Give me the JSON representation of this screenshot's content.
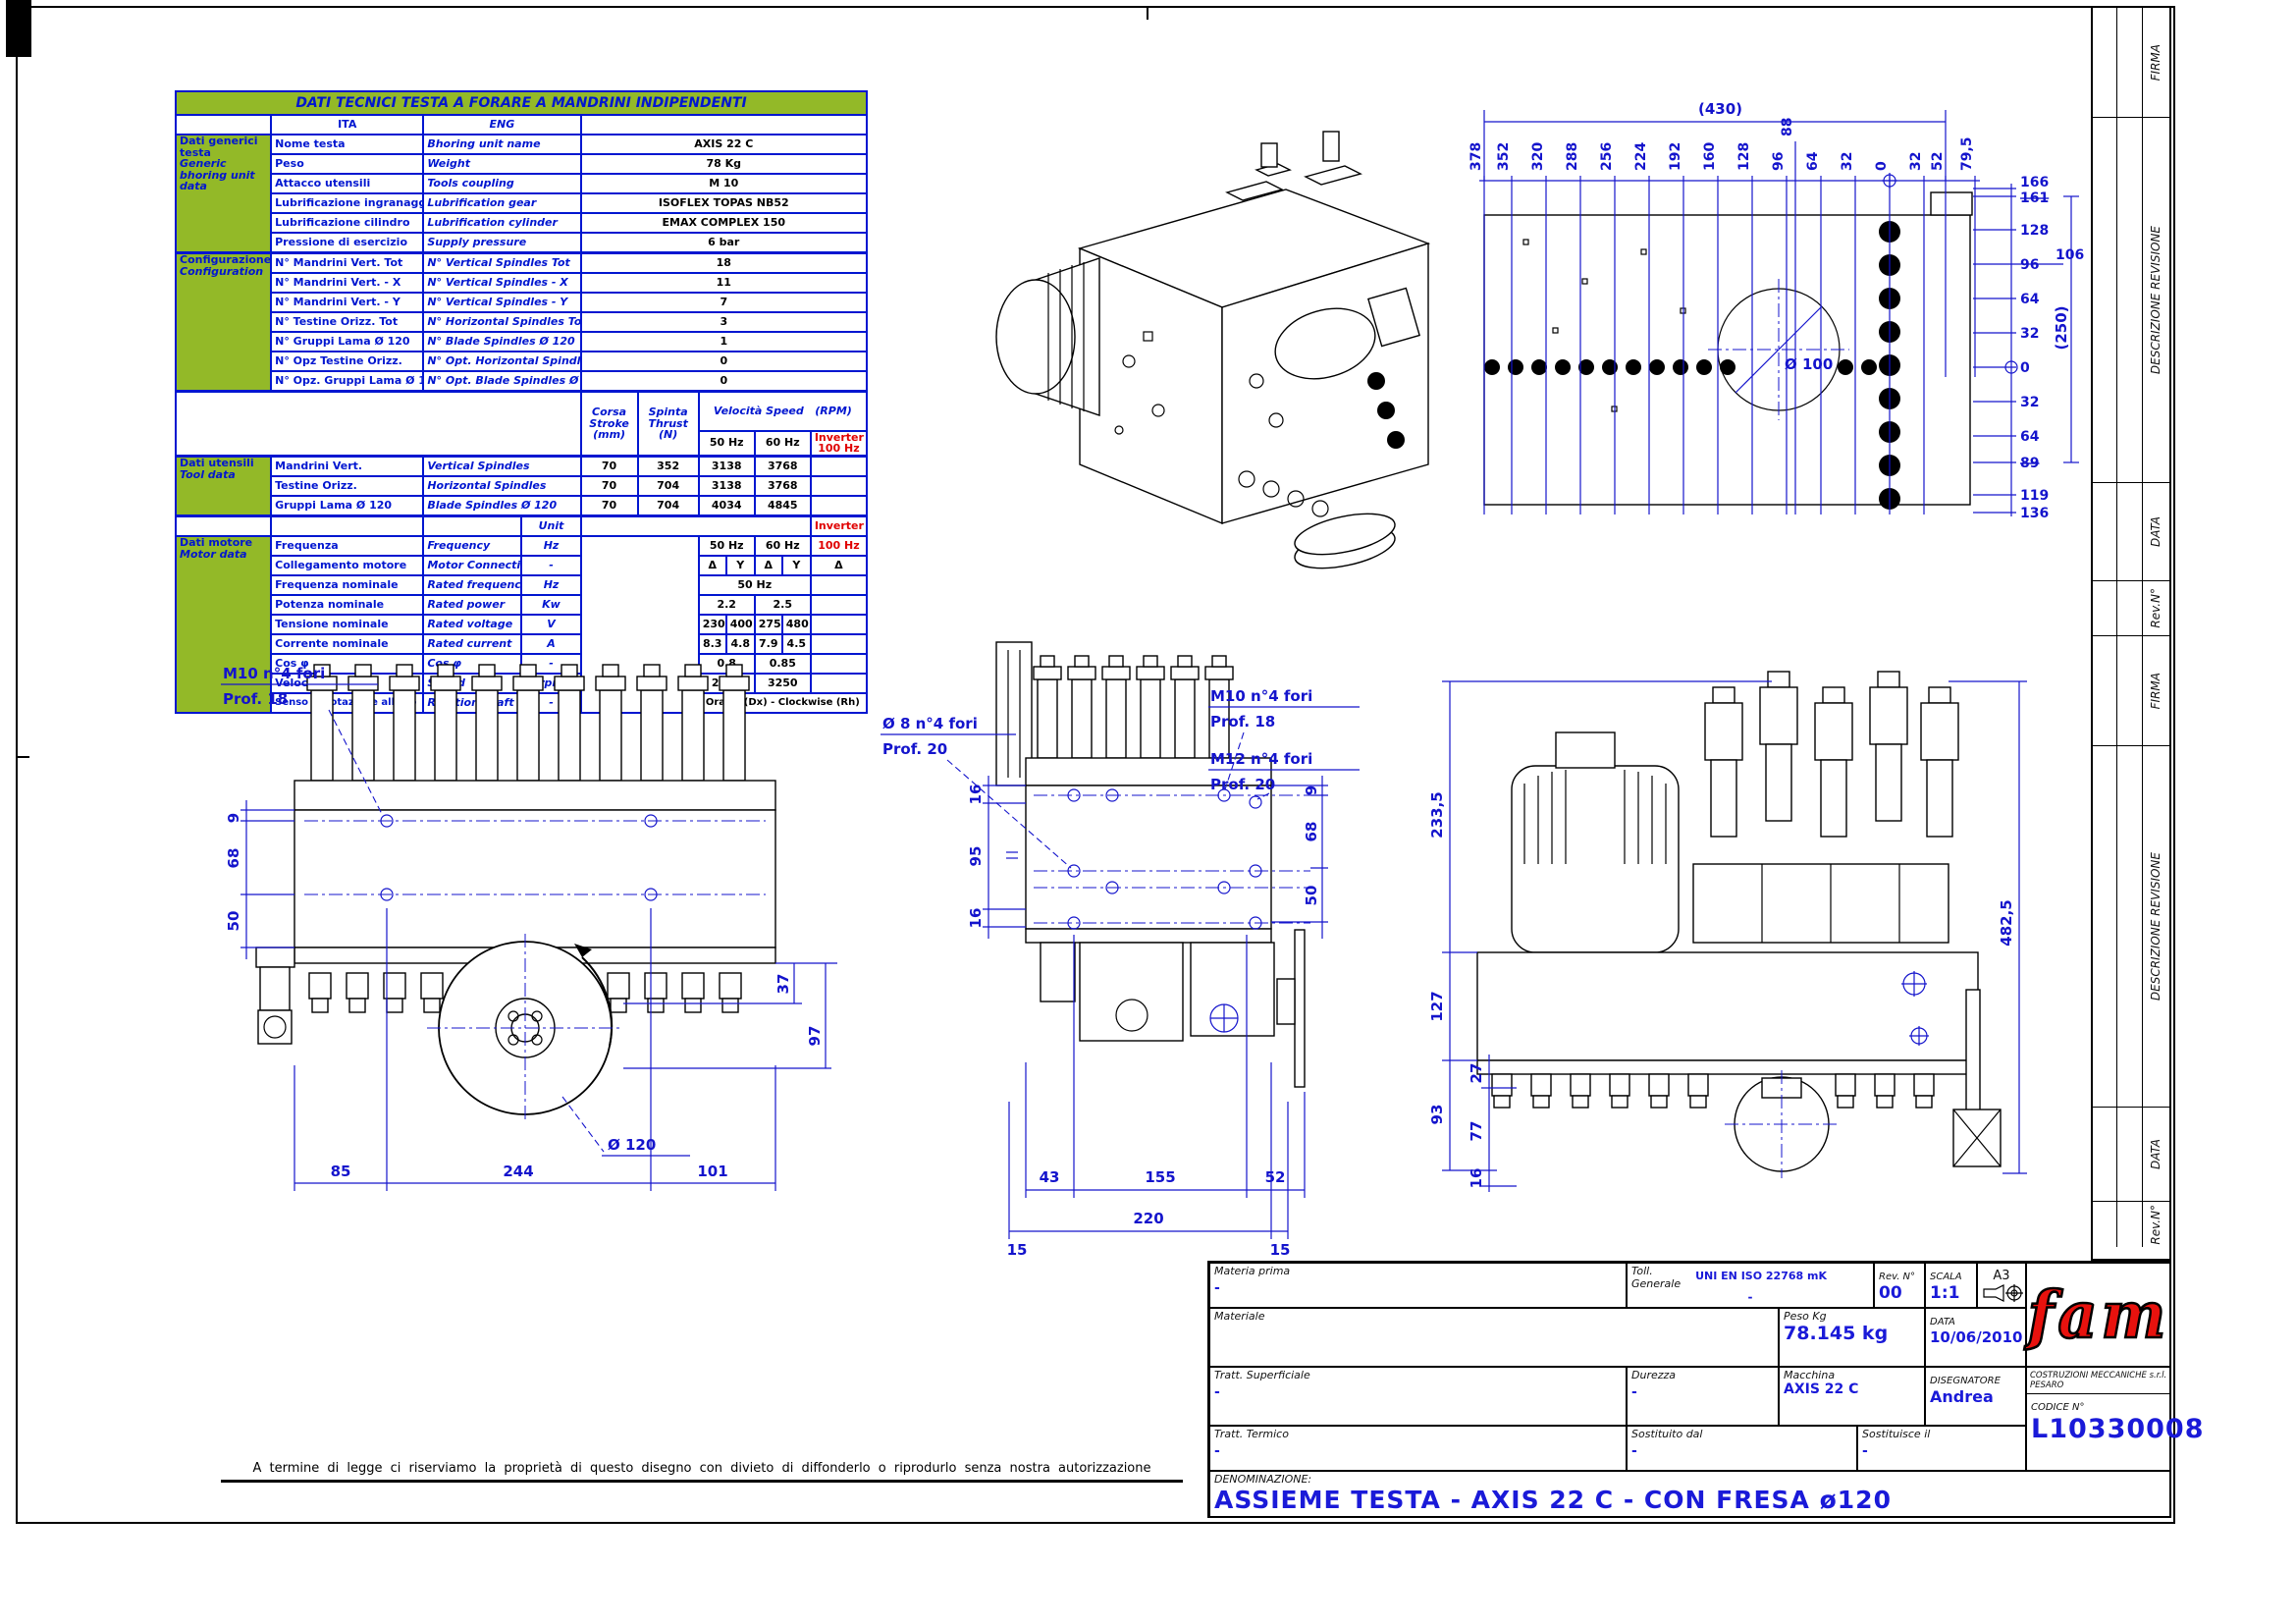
{
  "sheet": {
    "disclaimer": "A termine di legge ci riserviamo la proprietà di questo disegno con divieto di diffonderlo o riprodurlo senza nostra autorizzazione"
  },
  "colors": {
    "drawing_blue": "#1414cc",
    "table_blue": "#0016d0",
    "table_green": "#93b928",
    "alert_red": "#e00000",
    "logo_red": "#e8120e"
  },
  "tech_table": {
    "title": "DATI TECNICI TESTA A FORARE A MANDRINI INDIPENDENTI",
    "col_ita": "ITA",
    "col_eng": "ENG",
    "general": {
      "group_ita": "Dati generici testa",
      "group_eng": "Generic bhoring unit data",
      "rows": [
        {
          "ita": "Nome testa",
          "eng": "Bhoring unit name",
          "value": "AXIS 22 C"
        },
        {
          "ita": "Peso",
          "eng": "Weight",
          "value": "78 Kg"
        },
        {
          "ita": "Attacco utensili",
          "eng": "Tools coupling",
          "value": "M 10"
        },
        {
          "ita": "Lubrificazione ingranaggi",
          "eng": "Lubrification gear",
          "value": "ISOFLEX TOPAS NB52"
        },
        {
          "ita": "Lubrificazione cilindro",
          "eng": "Lubrification cylinder",
          "value": "EMAX COMPLEX 150"
        },
        {
          "ita": "Pressione di esercizio",
          "eng": "Supply pressure",
          "value": "6 bar"
        }
      ]
    },
    "config": {
      "group_ita": "Configurazione",
      "group_eng": "Configuration",
      "rows": [
        {
          "ita": "N° Mandrini Vert. Tot",
          "eng": "N° Vertical Spindles Tot",
          "value": "18"
        },
        {
          "ita": "N° Mandrini Vert. - X",
          "eng": "N° Vertical Spindles - X",
          "value": "11"
        },
        {
          "ita": "N° Mandrini Vert. - Y",
          "eng": "N° Vertical Spindles - Y",
          "value": "7"
        },
        {
          "ita": "N° Testine Orizz. Tot",
          "eng": "N° Horizontal Spindles Tot",
          "value": "3"
        },
        {
          "ita": "N° Gruppi Lama Ø 120",
          "eng": "N° Blade Spindles Ø 120",
          "value": "1"
        },
        {
          "ita": "N° Opz Testine Orizz.",
          "eng": "N° Opt. Horizontal Spindles",
          "value": "0"
        },
        {
          "ita": "N° Opz. Gruppi Lama Ø 120",
          "eng": "N° Opt. Blade Spindles Ø 120",
          "value": "0"
        }
      ]
    },
    "speed_header": {
      "corsa": "Corsa",
      "stroke": "Stroke",
      "mm": "(mm)",
      "spinta": "Spinta",
      "thrust": "Thrust",
      "n": "(N)",
      "velocita": "Velocità Speed",
      "rpm": "(RPM)",
      "hz50": "50 Hz",
      "hz60": "60 Hz",
      "inverter": "Inverter",
      "hz100": "100 Hz"
    },
    "tools": {
      "group_ita": "Dati utensili",
      "group_eng": "Tool data",
      "rows": [
        {
          "ita": "Mandrini Vert.",
          "eng": "Vertical Spindles",
          "corsa": "70",
          "spinta": "352",
          "v50": "3138",
          "v60": "3768"
        },
        {
          "ita": "Testine Orizz.",
          "eng": "Horizontal Spindles",
          "corsa": "70",
          "spinta": "704",
          "v50": "3138",
          "v60": "3768"
        },
        {
          "ita": "Gruppi Lama Ø 120",
          "eng": "Blade Spindles Ø 120",
          "corsa": "70",
          "spinta": "704",
          "v50": "4034",
          "v60": "4845"
        }
      ]
    },
    "motor": {
      "group_ita": "Dati motore",
      "group_eng": "Motor data",
      "unit": "Unit",
      "inverter": "Inverter",
      "freq": {
        "ita": "Frequenza",
        "eng": "Frequency",
        "unit": "Hz",
        "c1": "50 Hz",
        "c2": "60 Hz",
        "c3": "100 Hz"
      },
      "conn": {
        "ita": "Collegamento motore",
        "eng": "Motor Connection",
        "unit": "-",
        "d1": "Δ",
        "y1": "Y",
        "d2": "Δ",
        "y2": "Y",
        "inv": "Δ"
      },
      "rfreq": {
        "ita": "Frequenza nominale",
        "eng": "Rated frequency",
        "unit": "Hz",
        "value": "50 Hz"
      },
      "power": {
        "ita": "Potenza nominale",
        "eng": "Rated power",
        "unit": "Kw",
        "v50": "2.2",
        "v60": "2.5"
      },
      "volt": {
        "ita": "Tensione nominale",
        "eng": "Rated voltage",
        "unit": "V",
        "a": "230",
        "b": "400",
        "c": "275",
        "d": "480"
      },
      "curr": {
        "ita": "Corrente nominale",
        "eng": "Rated current",
        "unit": "A",
        "a": "8.3",
        "b": "4.8",
        "c": "7.9",
        "d": "4.5"
      },
      "cos": {
        "ita": "Cos φ",
        "eng": "Cos φ",
        "unit": "-",
        "v50": "0.8",
        "v60": "0.85"
      },
      "speed": {
        "ita": "Velocità",
        "eng": "Speed",
        "unit": "rpm",
        "v50": "2710",
        "v60": "3250"
      },
      "rot": {
        "ita": "Senso di rotazione albero",
        "eng": "Rotation shaft",
        "unit": "-",
        "value": "Orario (Dx) - Clockwise (Rh)"
      }
    }
  },
  "views": {
    "plan": {
      "dim_top": "(430)",
      "top_ticks": [
        "378",
        "352",
        "320",
        "288",
        "256",
        "224",
        "192",
        "160",
        "128",
        "96",
        "88",
        "64",
        "32",
        "0",
        "32",
        "52",
        "79,5"
      ],
      "right_ticks": [
        "166",
        "161",
        "128",
        "96",
        "64",
        "32",
        "0",
        "32",
        "64",
        "89",
        "119",
        "136"
      ],
      "offset_tick": "106",
      "dim_right": "(250)",
      "hole_label": "Ø 100"
    },
    "front": {
      "callout1a": "M10   n°4 fori",
      "callout1b": "Prof. 18",
      "left_dims": [
        "9",
        "68",
        "50"
      ],
      "right_dims": [
        "37",
        "97"
      ],
      "bottom_dims": [
        "85",
        "244",
        "101"
      ],
      "blade_label": "Ø 120"
    },
    "middle": {
      "callout1a": "Ø 8  n°4 fori",
      "callout1b": "Prof. 20",
      "callout2a": "M10   n°4 fori",
      "callout2b": "Prof. 18",
      "callout3a": "M12   n°4 fori",
      "callout3b": "Prof. 20",
      "left_dims": [
        "16",
        "95",
        "16"
      ],
      "right_dims": [
        "9",
        "68",
        "50"
      ],
      "bottom_dims1": [
        "43",
        "155",
        "52"
      ],
      "bottom_dims2": [
        "15",
        "220",
        "15"
      ]
    },
    "side": {
      "left_dims": [
        "233,5",
        "127",
        "93"
      ],
      "inner_dims": [
        "27",
        "77",
        "16"
      ],
      "right_dim": "482,5"
    }
  },
  "title_block": {
    "materia_prima_label": "Materia prima",
    "materia_prima_value": "-",
    "toll_label1": "Toll.",
    "toll_label2": "Generale",
    "toll_value1": "UNI EN ISO 22768 mK",
    "toll_value2": "-",
    "rev_label": "Rev. N°",
    "rev_value": "00",
    "scala_label": "SCALA",
    "scala_value": "1:1",
    "format": "A3",
    "materiale_label": "Materiale",
    "peso_label": "Peso Kg",
    "peso_value": "78.145 kg",
    "data_label": "DATA",
    "data_value": "10/06/2010",
    "tratt_sup_label": "Tratt. Superficiale",
    "tratt_sup_value": "-",
    "durezza_label": "Durezza",
    "durezza_value": "-",
    "macchina_label": "Macchina",
    "macchina_value": "AXIS 22 C",
    "disegnatore_label": "DISEGNATORE",
    "disegnatore_value": "Andrea",
    "company": "COSTRUZIONI MECCANICHE s.r.l. PESARO",
    "codice_label": "CODICE N°",
    "codice_value": "L10330008",
    "tratt_term_label": "Tratt. Termico",
    "tratt_term_value": "-",
    "sostituito_label": "Sostituito dal",
    "sostituito_value": "-",
    "sostituisce_label": "Sostituisce il",
    "sostituisce_value": "-",
    "denominazione_label": "DENOMINAZIONE:",
    "denominazione_value": "ASSIEME TESTA - AXIS 22 C - CON FRESA ø120",
    "logo": "fam"
  },
  "rev_strip": {
    "labels": [
      "FIRMA",
      "DESCRIZIONE REVISIONE",
      "DATA",
      "Rev.N°",
      "FIRMA",
      "DESCRIZIONE REVISIONE",
      "DATA",
      "Rev.N°"
    ]
  }
}
